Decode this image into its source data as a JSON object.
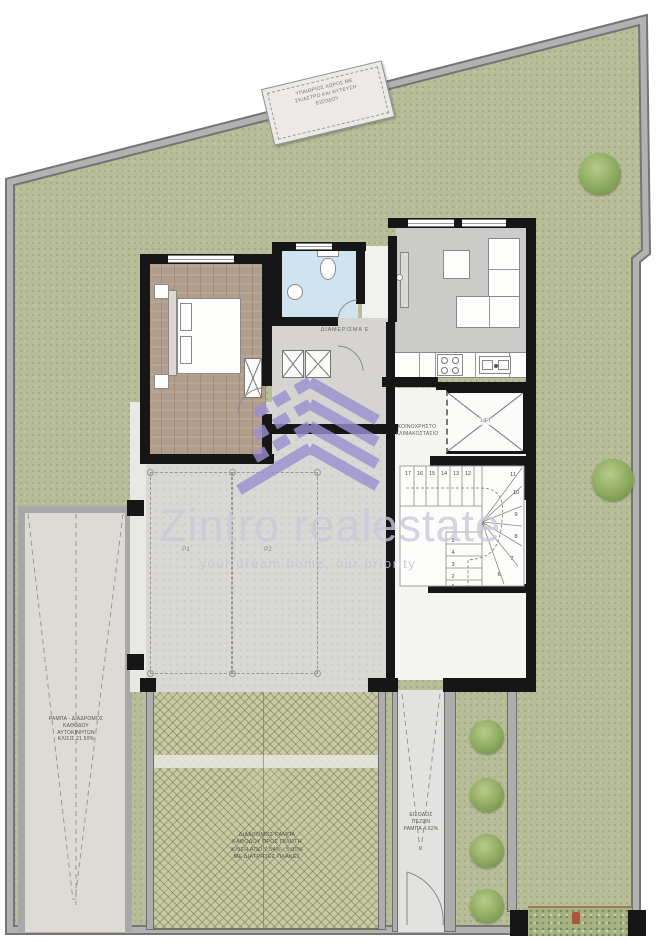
{
  "watermark": {
    "brand": "Zintro realestate",
    "tagline": "your dream home, our priority",
    "logo_color": "#9a90d1",
    "text_color": "#c7c9d9"
  },
  "site": {
    "pergola_box_lines": [
      "ΥΠΑΙΘΡΙΟΣ ΧΩΡΟΣ ΜΕ",
      "ΣΚΙΑΣΤΡΟ ΚΑΙ ΦΥΤΕΥΣΗ",
      "ΕΙΣΟΔΟΥ"
    ]
  },
  "apartment": {
    "label": "ΔΙΑΜΕΡΙΣΜΑ Ε"
  },
  "core": {
    "label_line1": "ΚΟΙΝΟΧΡΗΣΤΟ",
    "label_line2": "ΚΛΙΜΑΚΟΣΤΑΣΙΟ",
    "lift": "LIFT"
  },
  "parking": {
    "p1": "P1",
    "p2": "P2"
  },
  "car_ramp": {
    "lines": [
      "ΡΑΜΠΑ - ΔΙΑΔΡΟΜΟΣ",
      "ΚΑΘΟΔΟΥ",
      "ΑΥΤΟΚΙΝΗΤΩΝ",
      "ΚΛΙΣΙΣ 21.50%"
    ]
  },
  "walk_ramp": {
    "lines": [
      "ΔΙΑΔΡΟΜΟΣ  ΡΑΜΠΑ",
      "ΚΑΘΟΔΟΥ ΠΡΟΣ ΠΙΛΟΤΗ",
      "ΚΛΙΣΗ ΑΠΟ 7.54% - 5.00%",
      "ΜΕ ΔΙΑΤΡΗΤΕΣ ΠΛΑΚΕΣ"
    ]
  },
  "entrance": {
    "lines": [
      "ΕΙΣΟΔΟΣ",
      "ΠΕΖΩΝ",
      "ΡΑΜΠΑ 4.62%"
    ]
  },
  "stairs": {
    "upper": [
      "17",
      "16",
      "15",
      "14",
      "13",
      "12"
    ],
    "winder": [
      "11",
      "10",
      "9",
      "8",
      "7",
      "6"
    ],
    "lower": [
      "5",
      "4",
      "3",
      "2",
      "1"
    ]
  },
  "colors": {
    "lawn": "#b7bd98",
    "concrete": "#d9d8d4",
    "wood": "#b19d8b",
    "bathroom": "#cfe4ee",
    "hatch": "#c7caa4",
    "wall_gray": "#adadad",
    "wall_black": "#161616"
  }
}
